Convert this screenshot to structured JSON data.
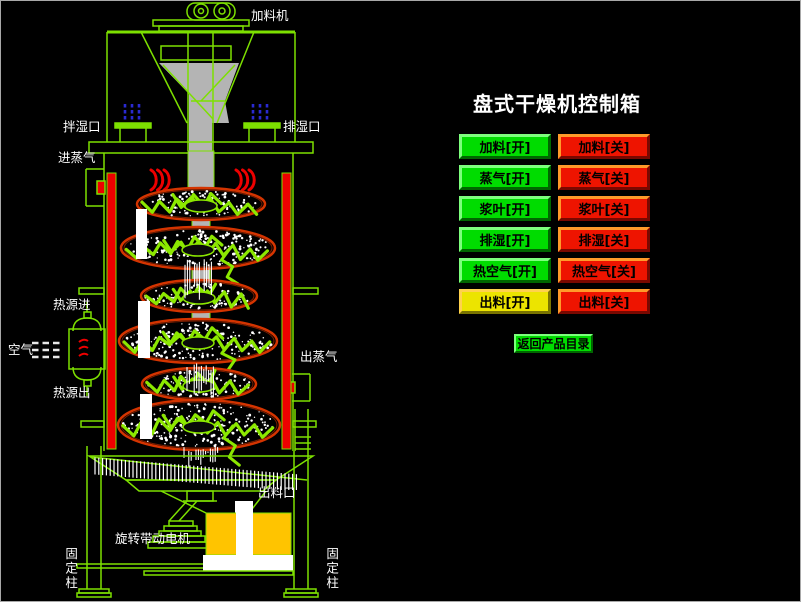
{
  "window": {
    "background": "#000000"
  },
  "panel": {
    "title": "盘式干燥机控制箱",
    "rows": [
      {
        "name": "feed",
        "on": "加料[开]",
        "off": "加料[关]",
        "on_color": "green"
      },
      {
        "name": "steam",
        "on": "蒸气[开]",
        "off": "蒸气[关]",
        "on_color": "green"
      },
      {
        "name": "paddle",
        "on": "浆叶[开]",
        "off": "浆叶[关]",
        "on_color": "green"
      },
      {
        "name": "dehumidify",
        "on": "排湿[开]",
        "off": "排湿[关]",
        "on_color": "green"
      },
      {
        "name": "hot-air",
        "on": "热空气[开]",
        "off": "热空气[关]",
        "on_color": "green"
      },
      {
        "name": "discharge",
        "on": "出料[开]",
        "off": "出料[关]",
        "on_color": "yellow"
      }
    ],
    "return_label": "返回产品目录",
    "colors": {
      "green": "#00dc00",
      "red": "#ee1400",
      "yellow": "#ece400"
    }
  },
  "diagram": {
    "labels": {
      "feeder": "加料机",
      "wet_mix_port": "拌湿口",
      "moisture_exhaust_port": "排湿口",
      "steam_inlet": "进蒸气",
      "heat_source_in": "热源进",
      "air": "空气",
      "heat_source_out": "热源出",
      "steam_outlet": "出蒸气",
      "discharge_port": "出料口",
      "drive_motor": "旋转带动电机",
      "fixed_column_left": "固定柱",
      "fixed_column_right": "固定柱"
    },
    "colors": {
      "line": "#7de000",
      "hot": "#ee0000",
      "paddle": "#8ce800",
      "disc_rim": "#d43400",
      "shaft": "#b4b4b4",
      "motor": "#ffc400",
      "dash_blue": "#2a2ad2"
    }
  }
}
